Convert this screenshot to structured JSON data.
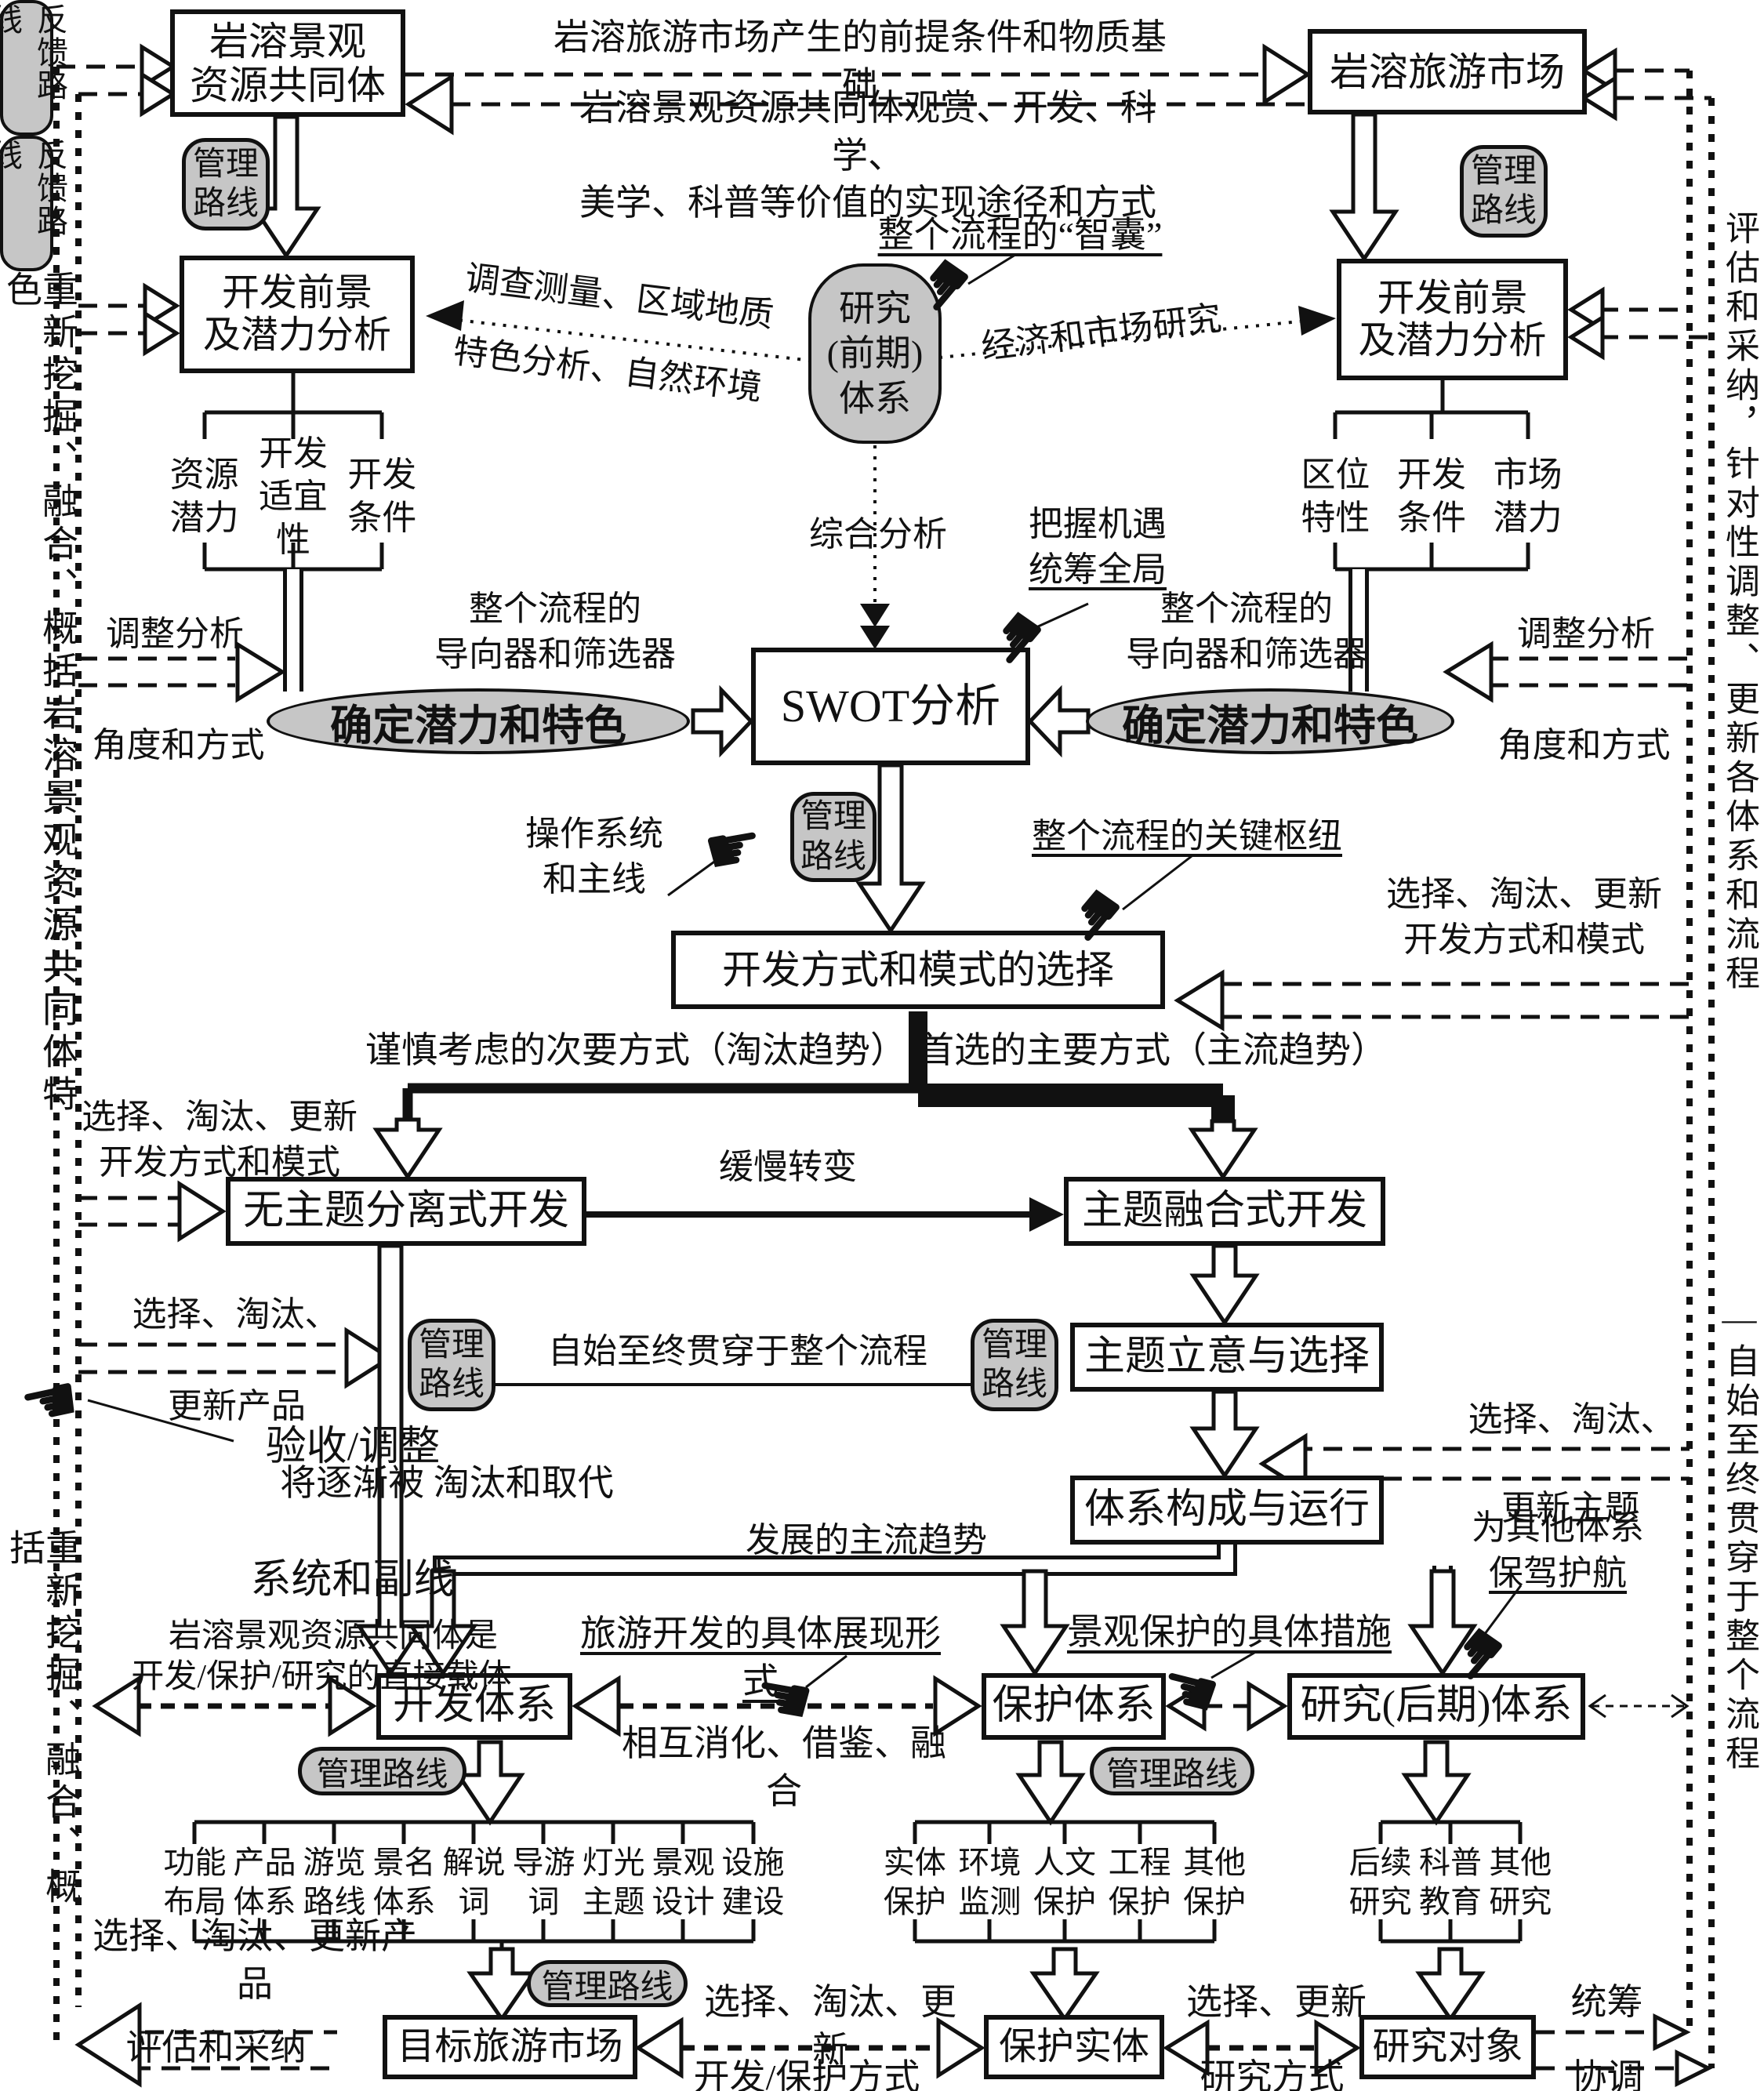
{
  "colors": {
    "gray": "#c6c6c6",
    "line": "#111111"
  },
  "boxes": {
    "karst_resource": "岩溶景观\n资源共同体",
    "karst_market": "岩溶旅游市场",
    "prospect_left": "开发前景\n及潜力分析",
    "prospect_right": "开发前景\n及潜力分析",
    "research_early": "研究\n(前期)\n体系",
    "swot": "SWOT分析",
    "mode_select": "开发方式和模式的选择",
    "no_theme_dev": "无主题分离式开发",
    "theme_fusion_dev": "主题融合式开发",
    "theme_select": "主题立意与选择",
    "system_run": "体系构成与运行",
    "dev_system": "开发体系",
    "protect_system": "保护体系",
    "research_late": "研究(后期)体系",
    "target_market": "目标旅游市场",
    "protect_entity": "保护实体",
    "research_object": "研究对象"
  },
  "ellipses": {
    "potential_left": "确定潜力和特色",
    "potential_right": "确定潜力和特色"
  },
  "pills": {
    "management": "管理\n路线",
    "management_h": "管理路线",
    "feedback": "反馈路线"
  },
  "tables": {
    "left": [
      "资源\n潜力",
      "开发\n适宜性",
      "开发\n条件"
    ],
    "right": [
      "区位\n特性",
      "开发\n条件",
      "市场\n潜力"
    ],
    "dev": [
      "功能\n布局",
      "产品\n体系",
      "游览\n路线",
      "景名\n体系",
      "解说\n词",
      "导游\n词",
      "灯光\n主题",
      "景观\n设计",
      "设施\n建设"
    ],
    "prot": [
      "实体\n保护",
      "环境\n监测",
      "人文\n保护",
      "工程\n保护",
      "其他\n保护"
    ],
    "res": [
      "后续\n研究",
      "科普\n教育",
      "其他\n研究"
    ]
  },
  "labels": {
    "premise": "岩溶旅游市场产生的前提条件和物质基础",
    "value_path": "岩溶景观资源共同体观赏、开发、科学、\n美学、科普等价值的实现途径和方式",
    "brain": "整个流程的“智囊”",
    "survey_line1": "调查测量、区域地质",
    "survey_line2": "特色分析、自然环境",
    "economy": "经济和市场研究",
    "synthesis": "综合分析",
    "grasp1": "把握机遇",
    "grasp2": "统筹全局",
    "guide_left": "整个流程的\n导向器和筛选器",
    "guide_right": "整个流程的\n导向器和筛选器",
    "adjust_left": "调整分析",
    "angle_left": "角度和方式",
    "adjust_right": "调整分析",
    "angle_right": "角度和方式",
    "operate": "操作系统\n和主线",
    "hub": "整个流程的关键枢纽",
    "select_mode_right": "选择、淘汰、更新\n开发方式和模式",
    "cautious": "谨慎考虑的次要方式（淘汰趋势）",
    "preferred": "首选的主要方式（主流趋势）",
    "select_mode_left": "选择、淘汰、更新\n开发方式和模式",
    "slow_change": "缓慢转变",
    "select_product_mid1": "选择、淘汰、",
    "select_product_mid2": "更新产品",
    "through_all": "自始至终贯穿于整个流程",
    "select_theme1": "选择、淘汰、",
    "select_theme2": "更新主题",
    "replaced": "将逐渐被 淘汰和取代",
    "accept1": "验收/调整",
    "accept2": "系统和副线",
    "carrier1": "岩溶景观资源共同体是",
    "carrier2": "开发/保护/研究的直接载体",
    "dev_form": "旅游开发的具体展现形式",
    "protect_measure": "景观保护的具体措施",
    "escort1": "为其他体系",
    "escort2": "保驾护航",
    "mainstream": "发展的主流趋势",
    "mutual": "相互消化、借鉴、融合",
    "select_product_bottom": "选择、淘汰、更新产品",
    "select_update": "选择、淘汰、更新",
    "dev_protect_mode": "开发/保护方式",
    "select_update2": "选择、更新",
    "research_mode": "研究方式",
    "overall1": "统筹",
    "overall2": "协调",
    "evaluate": "评估和采纳"
  },
  "sides": {
    "left_top": "重新挖掘、融合、概括岩溶景观资源共同体特色",
    "left_bottom": "重新挖掘、融合、概括",
    "right_top": "评估和采纳，针对性调整、更新各体系和流程",
    "right_bottom": "—自始至终贯穿于整个流程"
  },
  "icons": {
    "hand_right": "☛",
    "hand_left": "☚"
  }
}
